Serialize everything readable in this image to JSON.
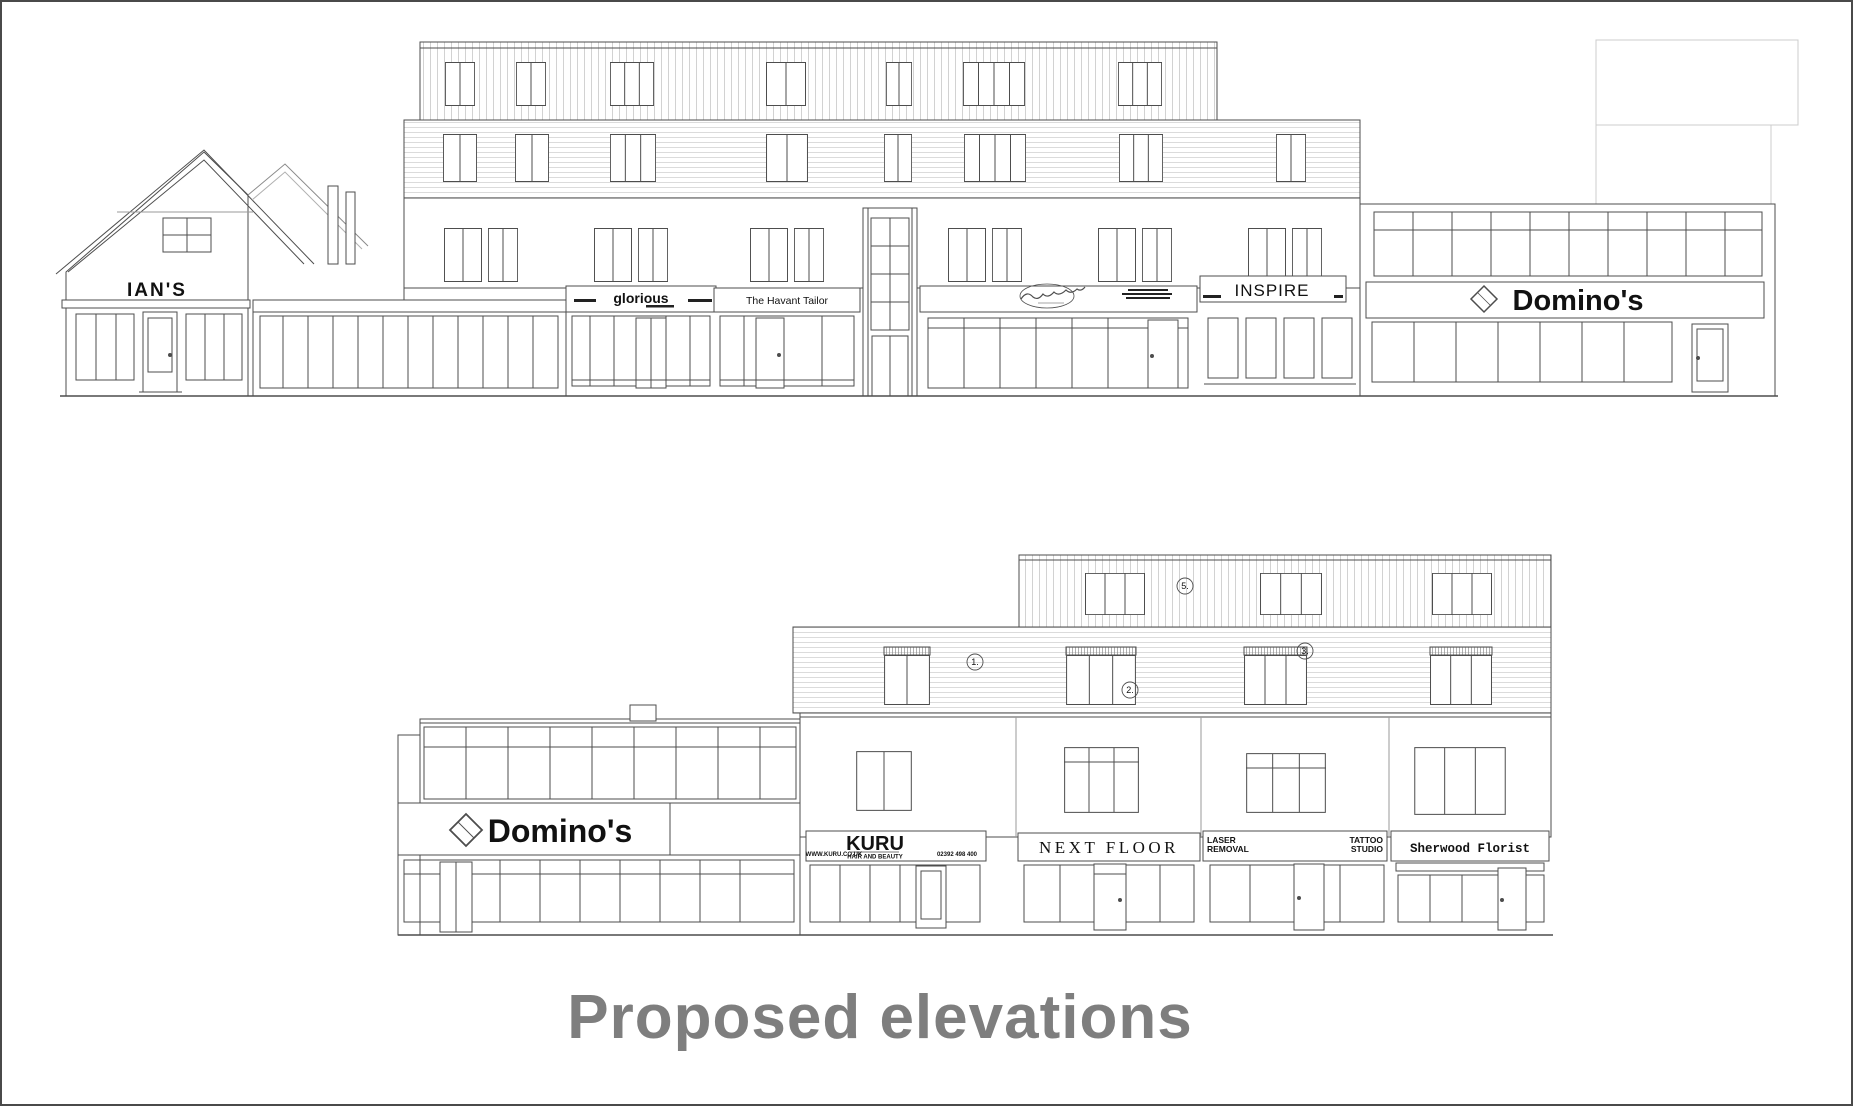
{
  "title": {
    "label": "Proposed elevations"
  },
  "colors": {
    "line": "#4d4d4d",
    "cladding_line": "#c7c7c7",
    "faint_outline": "#cccccc",
    "title_text": "#7e7e7e",
    "sign_text": "#111111"
  },
  "top_elevation": {
    "signs": {
      "ians": "IAN'S",
      "glorious": "glorious",
      "havant_tailor": "The Havant Tailor",
      "inspire": "INSPIRE",
      "dominos": "Domino's"
    }
  },
  "bottom_elevation": {
    "signs": {
      "dominos": "Domino's",
      "kuru": "KURU",
      "kuru_subtitle": "HAIR AND BEAUTY",
      "kuru_website": "WWW.KURU.CO.UK",
      "kuru_phone": "02392 498 400",
      "next_floor": "NEXT FLOOR",
      "laser_line1": "LASER",
      "laser_line2": "REMOVAL",
      "tattoo_line1": "TATTOO",
      "tattoo_line2": "STUDIO",
      "sherwood_florist": "Sherwood Florist"
    },
    "annotations": {
      "a1": "1.",
      "a2": "2.",
      "a3": "3.",
      "a5": "5."
    }
  }
}
